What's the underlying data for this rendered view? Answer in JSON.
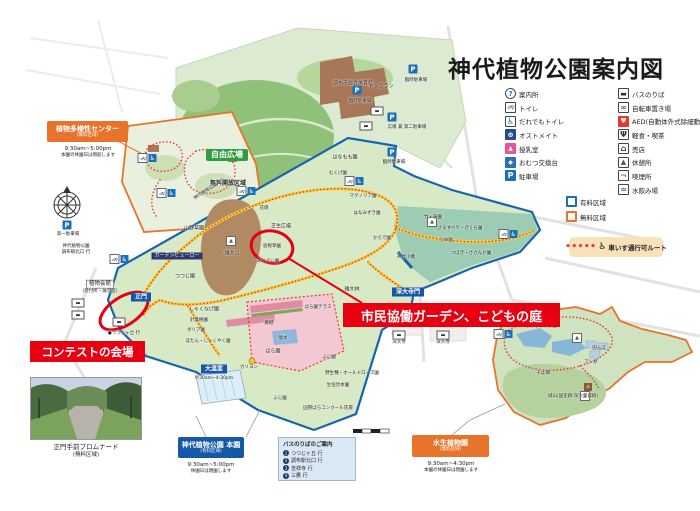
{
  "title": "神代植物公園案内図",
  "legend": {
    "col1": [
      {
        "icon": "info",
        "glyph": "?",
        "label": "案内所"
      },
      {
        "icon": "wc",
        "glyph": "♂♀",
        "label": "トイレ"
      },
      {
        "icon": "acc",
        "glyph": "♿",
        "label": "だれでもトイレ"
      },
      {
        "icon": "ost",
        "glyph": "⊕",
        "label": "オストメイト"
      },
      {
        "icon": "nurse",
        "glyph": "▲",
        "label": "授乳室"
      },
      {
        "icon": "diaper",
        "glyph": "◆",
        "label": "おむつ交換台"
      },
      {
        "icon": "park",
        "glyph": "P",
        "label": "駐車場"
      }
    ],
    "col2": [
      {
        "icon": "bus",
        "glyph": "▬",
        "label": "バスのりば"
      },
      {
        "icon": "bike",
        "glyph": "∞",
        "label": "自転車置き場"
      },
      {
        "icon": "aed",
        "glyph": "♥",
        "label": "AED(自動体外式除細動器)"
      },
      {
        "icon": "food",
        "glyph": "Ψ",
        "label": "軽食・喫茶"
      },
      {
        "icon": "shop",
        "glyph": "⌂",
        "label": "売店"
      },
      {
        "icon": "rest",
        "glyph": "▲",
        "label": "休憩所"
      },
      {
        "icon": "smoke",
        "glyph": "¬",
        "label": "喫煙所"
      },
      {
        "icon": "water",
        "glyph": "≈",
        "label": "水飲み場"
      }
    ],
    "areas": [
      {
        "icon": "paid",
        "glyph": "",
        "label": "有料区域"
      },
      {
        "icon": "free",
        "glyph": "",
        "label": "無料区域"
      }
    ],
    "wheelchair": {
      "dots": "•••••",
      "symbol": "♿",
      "label": "車いす通行可ルート"
    }
  },
  "annotations": {
    "contest": "コンテストの会場",
    "citizen_garden": "市民協働ガーデン、こどもの庭"
  },
  "areas": {
    "tayousei": {
      "name": "植物多様性センター",
      "zone": "(無料区域)",
      "hours": "9:30am~5:00pm",
      "note": "本園の休園日は閉館します"
    },
    "honen": {
      "name": "神代植物公園 本園",
      "zone": "(有料区域)",
      "hours": "9:30am~5:00pm",
      "note": "休園日は閉園します"
    },
    "suisei": {
      "name": "水生植物園",
      "zone": "(無料区域)",
      "hours": "9:30am~4:30pm",
      "note": "本園の休園日は閉園します"
    }
  },
  "bus_guide": {
    "title": "バスのりばのご案内",
    "routes": [
      {
        "n": "1",
        "label": "つつじヶ丘 行"
      },
      {
        "n": "2",
        "label": "調布駅北口 行"
      },
      {
        "n": "3",
        "label": "吉祥寺 行"
      },
      {
        "n": "4",
        "label": "三鷹 行"
      }
    ]
  },
  "photo": {
    "caption": "正門手前プロムナード",
    "zone": "(無料区域)"
  },
  "colors": {
    "paid_boundary": "#1665ad",
    "free_boundary": "#e8732a",
    "route_red": "#e8382d",
    "annotation_red": "#e60012"
  },
  "map_labels": [
    {
      "t": "自由広場",
      "x": 227,
      "y": 155,
      "c": "bgreen"
    },
    {
      "t": "無料開放区域",
      "x": 228,
      "y": 184,
      "c": "s4"
    },
    {
      "t": "調布市総合体育館",
      "x": 353,
      "y": 84,
      "c": "s35 onbrown"
    },
    {
      "t": "ドッグラン",
      "x": 381,
      "y": 87,
      "c": "s35"
    },
    {
      "t": "臨時駐車場",
      "x": 360,
      "y": 102,
      "c": "s3"
    },
    {
      "t": "臨時駐車場",
      "x": 416,
      "y": 81,
      "c": "s3"
    },
    {
      "t": "広場 兼 第二駐車場",
      "x": 407,
      "y": 128,
      "c": "s3"
    },
    {
      "t": "臨時駐車場",
      "x": 394,
      "y": 163,
      "c": "s3"
    },
    {
      "t": "はなもも園",
      "x": 345,
      "y": 158,
      "c": "s35"
    },
    {
      "t": "第一駐車場",
      "x": 68,
      "y": 235,
      "c": "s3"
    },
    {
      "t": "神代植物公園",
      "x": 76,
      "y": 247,
      "c": "s3"
    },
    {
      "t": "調布駅北口 行",
      "x": 76,
      "y": 253,
      "c": "s3"
    },
    {
      "t": "神代植物公園通り",
      "x": 210,
      "y": 190,
      "c": "s3 rot"
    },
    {
      "t": "山野草園",
      "x": 194,
      "y": 229,
      "c": "s35"
    },
    {
      "t": "花壇",
      "x": 264,
      "y": 209,
      "c": "s3"
    },
    {
      "t": "芝生広場",
      "x": 281,
      "y": 227,
      "c": "s35"
    },
    {
      "t": "宿根草園",
      "x": 272,
      "y": 247,
      "c": "s3"
    },
    {
      "t": "あじさい園",
      "x": 268,
      "y": 262,
      "c": "s3"
    },
    {
      "t": "雑木山",
      "x": 232,
      "y": 254,
      "c": "s35"
    },
    {
      "t": "つつじ園",
      "x": 185,
      "y": 277,
      "c": "s35"
    },
    {
      "t": "ガーデンビューロー",
      "x": 177,
      "y": 256,
      "c": "bnavy"
    },
    {
      "t": "植物会館",
      "x": 100,
      "y": 284,
      "c": "chip"
    },
    {
      "t": "(受付所・展示室)",
      "x": 100,
      "y": 292,
      "c": "s3"
    },
    {
      "t": "正門",
      "x": 141,
      "y": 297,
      "c": "bblue"
    },
    {
      "t": "●つつじヶ丘 行",
      "x": 124,
      "y": 334,
      "c": "s3"
    },
    {
      "t": "しゃくなげ園",
      "x": 204,
      "y": 310,
      "c": "s35"
    },
    {
      "t": "針葉樹園",
      "x": 199,
      "y": 321,
      "c": "s3"
    },
    {
      "t": "ダリア園",
      "x": 196,
      "y": 331,
      "c": "s3"
    },
    {
      "t": "ぼたん・しゃくやく園",
      "x": 208,
      "y": 342,
      "c": "s3"
    },
    {
      "t": "大温室",
      "x": 214,
      "y": 369,
      "c": "bblue"
    },
    {
      "t": "9:30am~4:30pm",
      "x": 214,
      "y": 379,
      "c": "s3"
    },
    {
      "t": "カリヨン",
      "x": 249,
      "y": 368,
      "c": "s3"
    },
    {
      "t": "ばら園",
      "x": 273,
      "y": 352,
      "c": "s35"
    },
    {
      "t": "噴水",
      "x": 283,
      "y": 339,
      "c": "s3"
    },
    {
      "t": "藤棚",
      "x": 269,
      "y": 324,
      "c": "s3"
    },
    {
      "t": "ばら園テラス",
      "x": 318,
      "y": 308,
      "c": "s3"
    },
    {
      "t": "ふじ園",
      "x": 329,
      "y": 358,
      "c": "s3"
    },
    {
      "t": "ふじ園",
      "x": 280,
      "y": 399,
      "c": "s3"
    },
    {
      "t": "野生種・オールドローズ園",
      "x": 352,
      "y": 374,
      "c": "s3"
    },
    {
      "t": "生垣見本園",
      "x": 338,
      "y": 386,
      "c": "s3"
    },
    {
      "t": "国際ばらコンクール花壇",
      "x": 328,
      "y": 409,
      "c": "s3"
    },
    {
      "t": "雑木林",
      "x": 352,
      "y": 290,
      "c": "s35"
    },
    {
      "t": "むくげ園",
      "x": 338,
      "y": 174,
      "c": "s3"
    },
    {
      "t": "マグノリア園",
      "x": 363,
      "y": 197,
      "c": "s3"
    },
    {
      "t": "はなみずき園",
      "x": 367,
      "y": 214,
      "c": "s3"
    },
    {
      "t": "かえで園",
      "x": 382,
      "y": 239,
      "c": "s3"
    },
    {
      "t": "神代小橋",
      "x": 406,
      "y": 258,
      "c": "s3"
    },
    {
      "t": "竹・笹園",
      "x": 433,
      "y": 218,
      "c": "s3"
    },
    {
      "t": "さるすべり・ざくら園",
      "x": 460,
      "y": 229,
      "c": "s3"
    },
    {
      "t": "うめ園",
      "x": 446,
      "y": 241,
      "c": "s3"
    },
    {
      "t": "つばき・さざんか園",
      "x": 471,
      "y": 254,
      "c": "s3"
    },
    {
      "t": "深大寺門",
      "x": 408,
      "y": 292,
      "c": "bblue"
    },
    {
      "t": "深大寺",
      "x": 399,
      "y": 343,
      "c": "s3"
    },
    {
      "t": "深大寺",
      "x": 443,
      "y": 343,
      "c": "s3"
    },
    {
      "t": "はなしょうぶ園",
      "x": 541,
      "y": 327,
      "c": "s3"
    },
    {
      "t": "田んぼ",
      "x": 599,
      "y": 349,
      "c": "s3"
    },
    {
      "t": "アシ原",
      "x": 591,
      "y": 363,
      "c": "s3"
    },
    {
      "t": "そば畑",
      "x": 543,
      "y": 374,
      "c": "s3"
    },
    {
      "t": "城山(国史跡:深大寺城跡)",
      "x": 573,
      "y": 397,
      "c": "s3"
    }
  ],
  "map_icons": [
    {
      "k": "p",
      "x": 67,
      "y": 225
    },
    {
      "k": "p",
      "x": 357,
      "y": 90
    },
    {
      "k": "p",
      "x": 413,
      "y": 69
    },
    {
      "k": "p",
      "x": 392,
      "y": 117
    },
    {
      "k": "p",
      "x": 392,
      "y": 152
    },
    {
      "k": "bus",
      "x": 377,
      "y": 111
    },
    {
      "k": "bus",
      "x": 366,
      "y": 126
    },
    {
      "k": "bus",
      "x": 78,
      "y": 303
    },
    {
      "k": "bus",
      "x": 78,
      "y": 315
    },
    {
      "k": "bus",
      "x": 119,
      "y": 322
    },
    {
      "k": "bus",
      "x": 399,
      "y": 335
    },
    {
      "k": "bus",
      "x": 443,
      "y": 335
    },
    {
      "k": "wc",
      "x": 147,
      "y": 158
    },
    {
      "k": "wc",
      "x": 166,
      "y": 193
    },
    {
      "k": "wc",
      "x": 246,
      "y": 191
    },
    {
      "k": "wc",
      "x": 354,
      "y": 181
    },
    {
      "k": "wc",
      "x": 119,
      "y": 259
    },
    {
      "k": "wc",
      "x": 508,
      "y": 234
    },
    {
      "k": "wc",
      "x": 503,
      "y": 334
    },
    {
      "k": "rest",
      "x": 231,
      "y": 241
    },
    {
      "k": "rest",
      "x": 432,
      "y": 222
    },
    {
      "k": "rest",
      "x": 577,
      "y": 338
    },
    {
      "k": "rest",
      "x": 585,
      "y": 396
    },
    {
      "k": "hut",
      "x": 588,
      "y": 387
    }
  ]
}
